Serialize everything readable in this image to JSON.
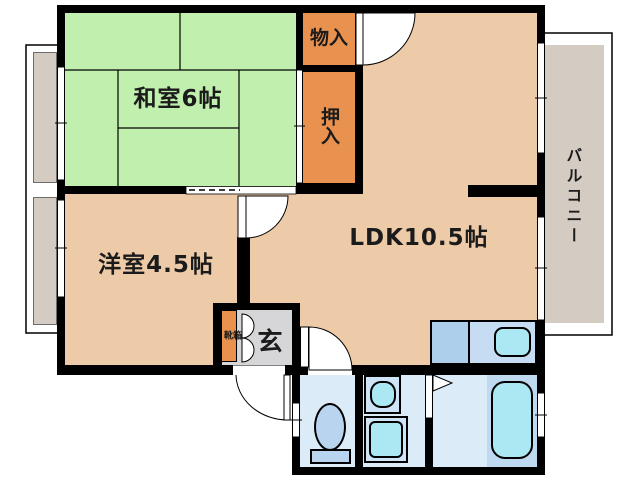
{
  "plan_title": "2DK apartment floor plan",
  "rooms": {
    "washitsu": {
      "label": "和室6帖"
    },
    "yoshitsu": {
      "label": "洋室4.5帖"
    },
    "ldk": {
      "label": "LDK10.5帖"
    },
    "monoire": {
      "label": "物入"
    },
    "oshiire": {
      "label": "押入"
    },
    "balcony": {
      "label": "バルコニー"
    },
    "genkan": {
      "label": "玄"
    },
    "shoe_cabinet": {
      "label": "靴箱"
    }
  },
  "colors": {
    "wall_black": "#000000",
    "tatami_green": "#c0efae",
    "floor_tan": "#edcba8",
    "closet_orange": "#e9914e",
    "genkan_gray": "#d6d6d8",
    "balcony_gray": "#d4ccc3",
    "wet_room_floor": "#dcebf8",
    "fixture_blue": "#b9d4ef",
    "fixture_light_blue": "#cfe3f6",
    "water_cyan": "#abe8f3",
    "tub_platform_blue": "#bfd9f1",
    "kitchen_counter_left": "#aecfec",
    "kitchen_counter_right": "#c6dcf2"
  }
}
